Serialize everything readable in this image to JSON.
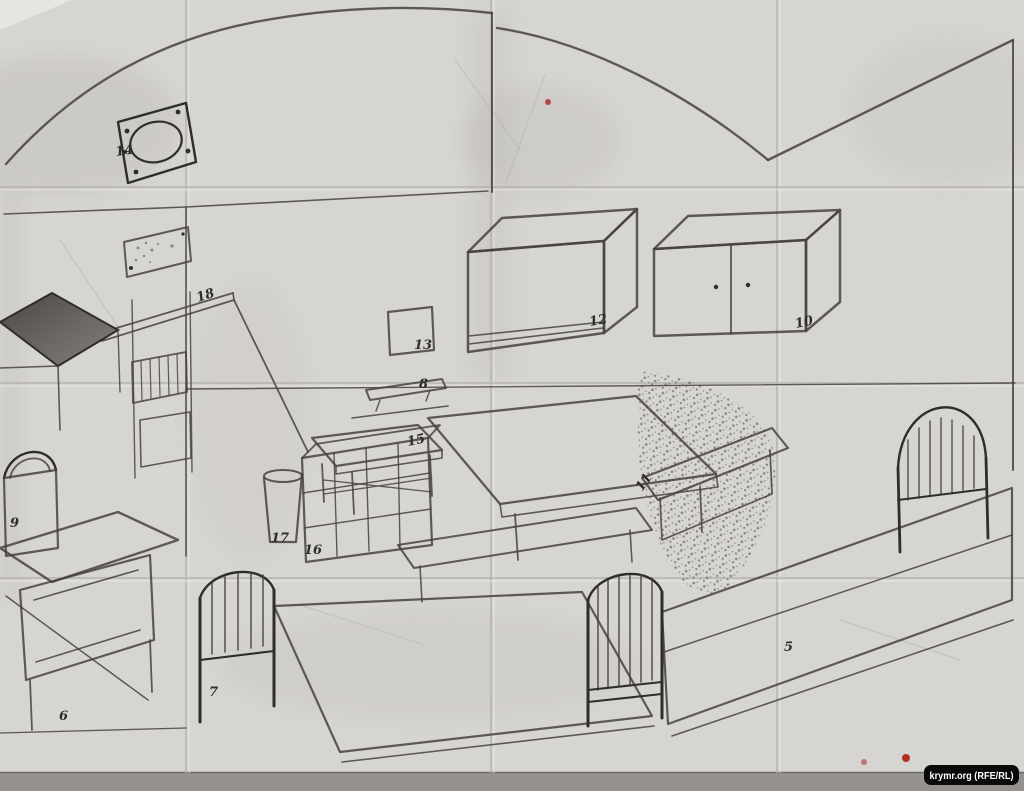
{
  "sketch": {
    "labels": [
      {
        "item": "wall-vent-plate",
        "text": "14"
      },
      {
        "item": "wall-board-shelf",
        "text": "18"
      },
      {
        "item": "wall-mirror-square",
        "text": "13"
      },
      {
        "item": "wall-cabinet-left",
        "text": "12"
      },
      {
        "item": "wall-cabinet-right",
        "text": "10"
      },
      {
        "item": "hanging-shelf",
        "text": "8"
      },
      {
        "item": "small-table",
        "text": "15"
      },
      {
        "item": "bench",
        "text": "11"
      },
      {
        "item": "bucket",
        "text": "17"
      },
      {
        "item": "cubby-shelf",
        "text": "16"
      },
      {
        "item": "nightstand",
        "text": "9"
      },
      {
        "item": "low-table",
        "text": "6"
      },
      {
        "item": "bed-left",
        "text": "7"
      },
      {
        "item": "bed-right",
        "text": "5"
      }
    ],
    "watermark": {
      "text": "krymr.org (RFE/RL)"
    }
  },
  "colors": {
    "paper": "#d7d5d2",
    "pencil": "#45423f",
    "pencil_dark": "#2f2d2b",
    "crease": "#b6b3af",
    "crease_highlight": "#eae8e5",
    "scan_strip": "#96938f",
    "red_dot": "#b03028",
    "watermark_bg": "#0a0a0a",
    "watermark_fg": "#ffffff"
  }
}
